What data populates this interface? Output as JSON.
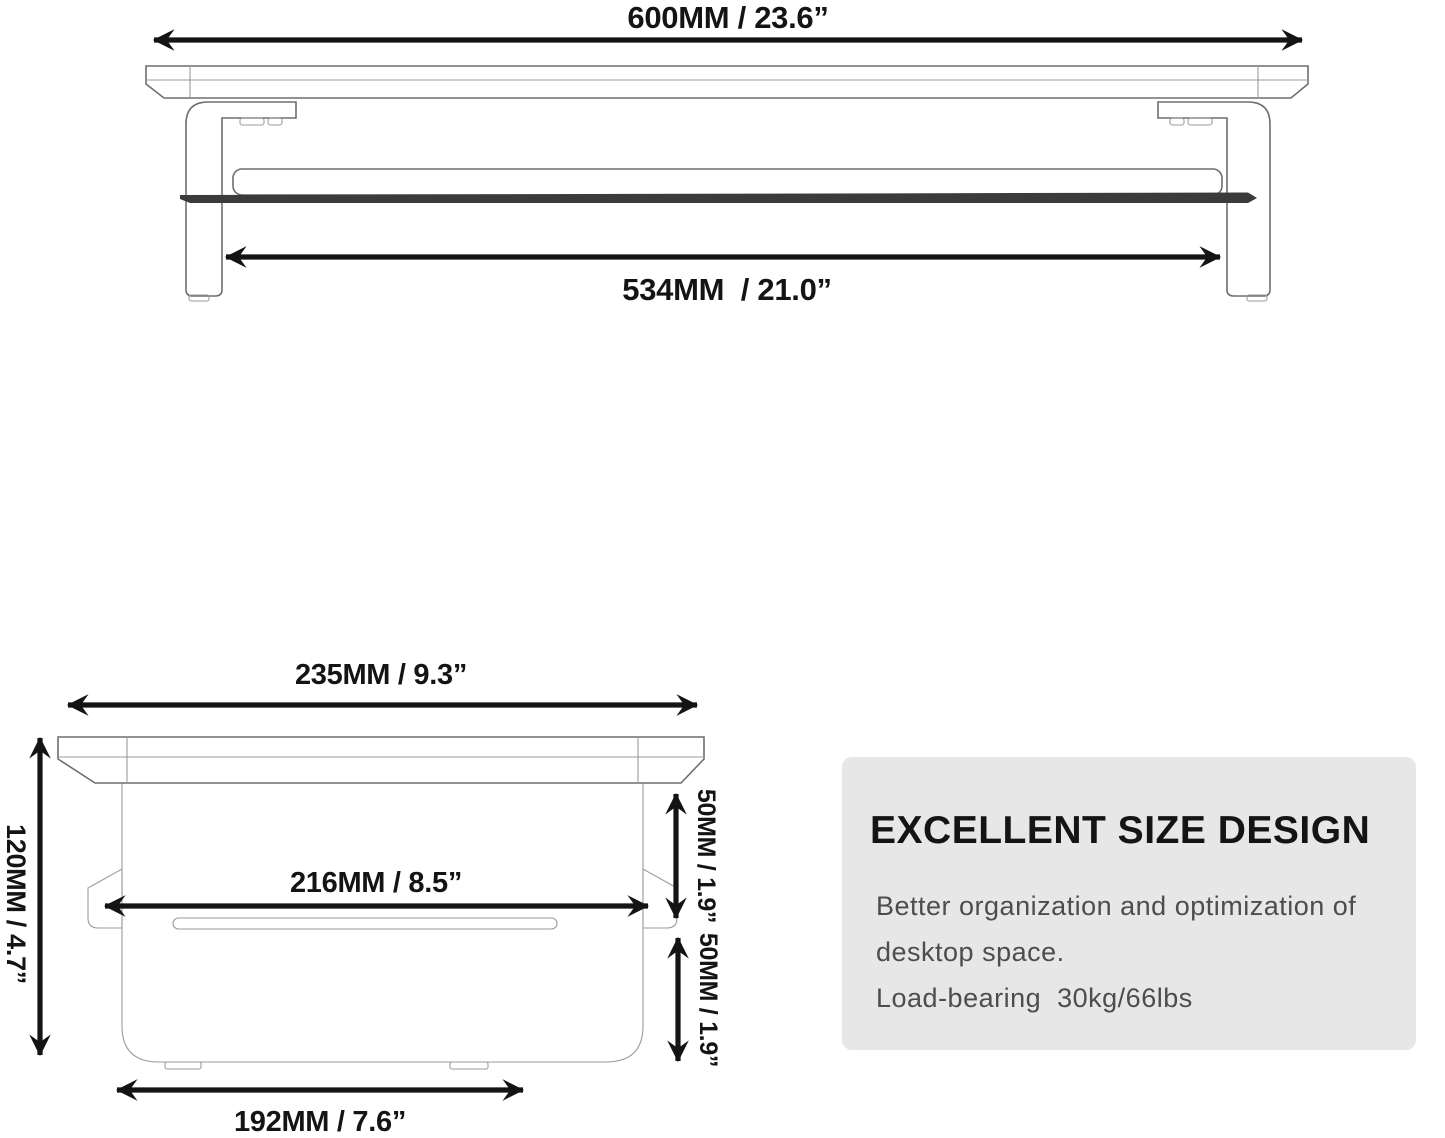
{
  "front_view": {
    "top_width_label": "600MM / 23.6”",
    "inner_width_label": "534MM  / 21.0”"
  },
  "side_view": {
    "top_depth_label": "235MM / 9.3”",
    "height_label": "120MM / 4.7”",
    "shelf_depth_label": "216MM / 8.5”",
    "upper_clearance_label": "50MM / 1.9”",
    "lower_clearance_label": "50MM / 1.9”",
    "base_depth_label": "192MM / 7.6”"
  },
  "info_box": {
    "title": "EXCELLENT SIZE DESIGN",
    "body_line1": "Better organization and optimization of",
    "body_line2": "desktop space.",
    "body_line3": "Load-bearing  30kg/66lbs",
    "background": "#e7e7e7",
    "title_color": "#141414",
    "body_color": "#4d4d4d"
  },
  "colors": {
    "arrow": "#141414",
    "dark_shelf_edge": "#3b3b3b",
    "background": "#ffffff"
  }
}
